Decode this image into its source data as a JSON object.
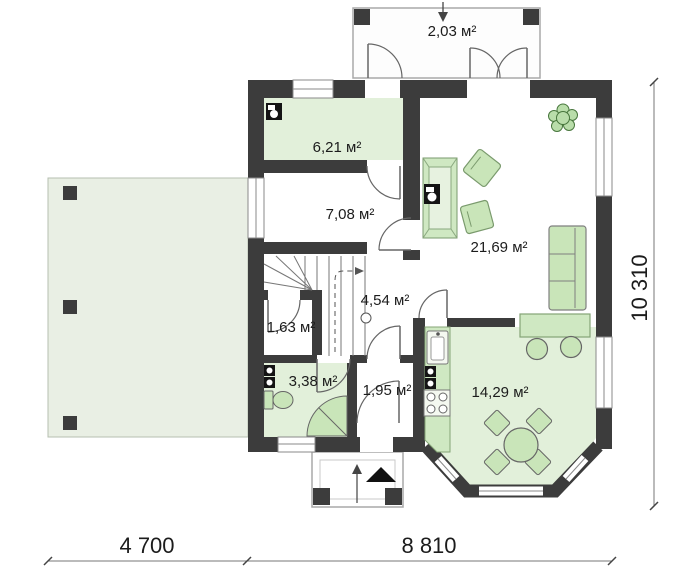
{
  "plan": {
    "rooms": [
      {
        "name": "entry-porch",
        "label": "2,03 м²"
      },
      {
        "name": "utility-room",
        "label": "6,21 м²"
      },
      {
        "name": "hallway",
        "label": "7,08 м²"
      },
      {
        "name": "stair-hall",
        "label": "4,54 м²"
      },
      {
        "name": "closet",
        "label": "1,63 м²"
      },
      {
        "name": "bathroom",
        "label": "3,38 м²"
      },
      {
        "name": "vestibule",
        "label": "1,95 м²"
      },
      {
        "name": "kitchen",
        "label": "14,29 м²"
      },
      {
        "name": "living-room",
        "label": "21,69 м²"
      }
    ],
    "dimensions": {
      "bottom_left": "4 700",
      "bottom_right": "8 810",
      "right_side": "10 310"
    },
    "colors": {
      "wall": "#3c3c3c",
      "room_green": "#e2f0da",
      "terrace_green": "#e9efe4",
      "furniture_green": "#c9e5b9",
      "counter_green": "#cfe8c2"
    },
    "fixtures": [
      "boiler-icon",
      "washing-machine-icon",
      "toilet-icon",
      "corner-shower-icon",
      "staircase",
      "fireplace-icon",
      "sofa-icon",
      "ottoman-icon",
      "plant-icon",
      "bar-counter",
      "bar-stool-icon",
      "kitchen-sink-icon",
      "oven-icon",
      "stove-icon",
      "dining-table-icon",
      "chair-icon",
      "entry-arrow-icon"
    ]
  }
}
